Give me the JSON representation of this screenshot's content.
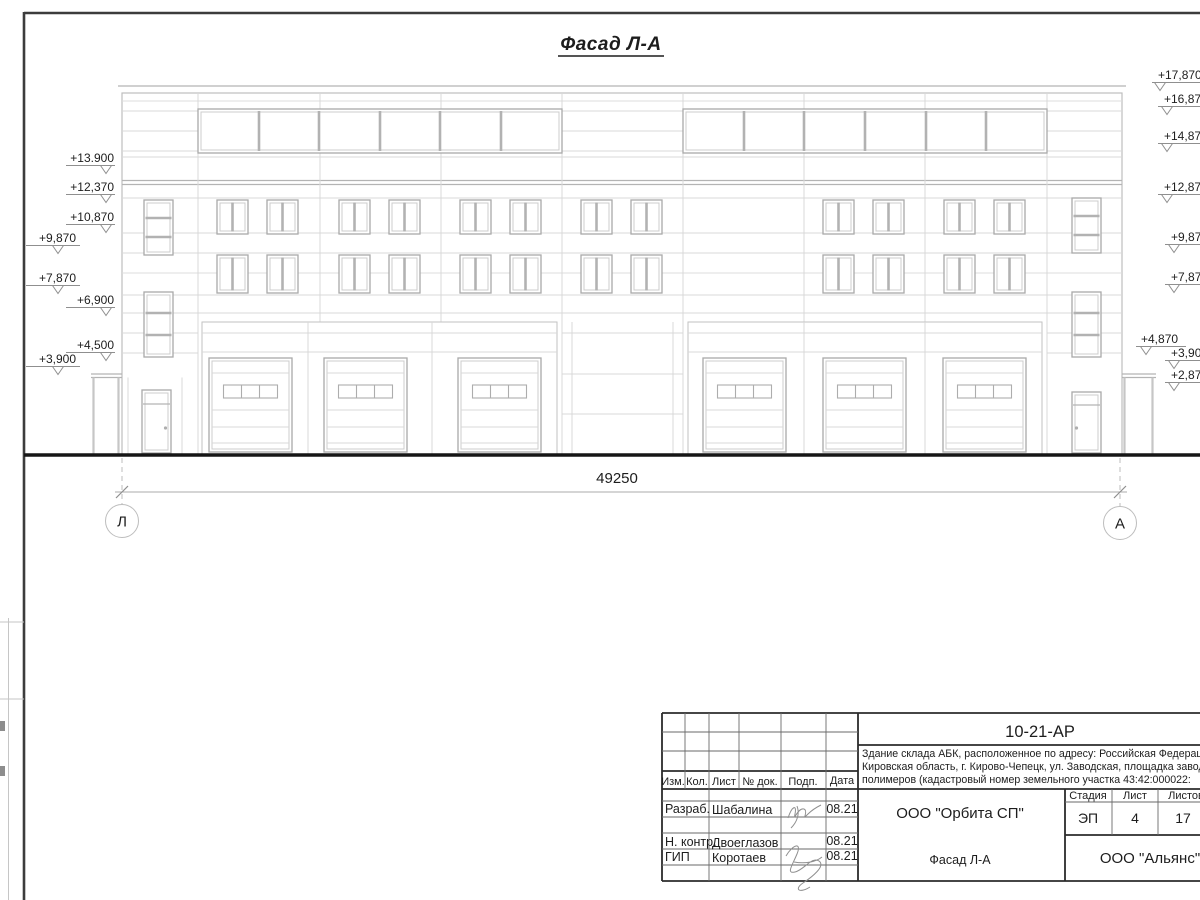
{
  "drawing": {
    "title": "Фасад Л-А",
    "dimension_total": "49250",
    "axis_left": "Л",
    "axis_right": "А",
    "elev_left": [
      "+13.900",
      "+12,370",
      "+10,870",
      "+9,870",
      "+7,870",
      "+6,900",
      "+4,500",
      "+3,900"
    ],
    "elev_right": [
      "+17,870",
      "+16,870",
      "+14,870",
      "+12,870",
      "+9,870",
      "+7,870",
      "+4,870",
      "+3,900",
      "+2,870"
    ]
  },
  "titleblock": {
    "doc_no": "10-21-АР",
    "desc1": "Здание склада АБК, расположенное по адресу: Российская Федерация,",
    "desc2": "Кировская область, г. Кирово-Чепецк, ул. Заводская, площадка завода",
    "desc3": "полимеров (кадастровый номер земельного участка 43:42:000022:",
    "col_izm": "Изм.",
    "col_kol": "Кол.",
    "col_list": "Лист",
    "col_ndok": "№ док.",
    "col_podp": "Подп.",
    "col_data": "Дата",
    "row1_role": "Разраб.",
    "row1_name": "Шабалина",
    "row1_date": "08.21",
    "row2_role": "Н. контр.",
    "row2_name": "Двоеглазов",
    "row2_date": "08.21",
    "row3_role": "ГИП",
    "row3_name": "Коротаев",
    "row3_date": "08.21",
    "org": "ООО \"Орбита СП\"",
    "stage_h": "Стадия",
    "sheet_h": "Лист",
    "sheets_h": "Листов",
    "stage_v": "ЭП",
    "sheet_v": "4",
    "sheets_v": "17",
    "view_name": "Фасад Л-А",
    "firm": "ООО \"Альянс\""
  }
}
